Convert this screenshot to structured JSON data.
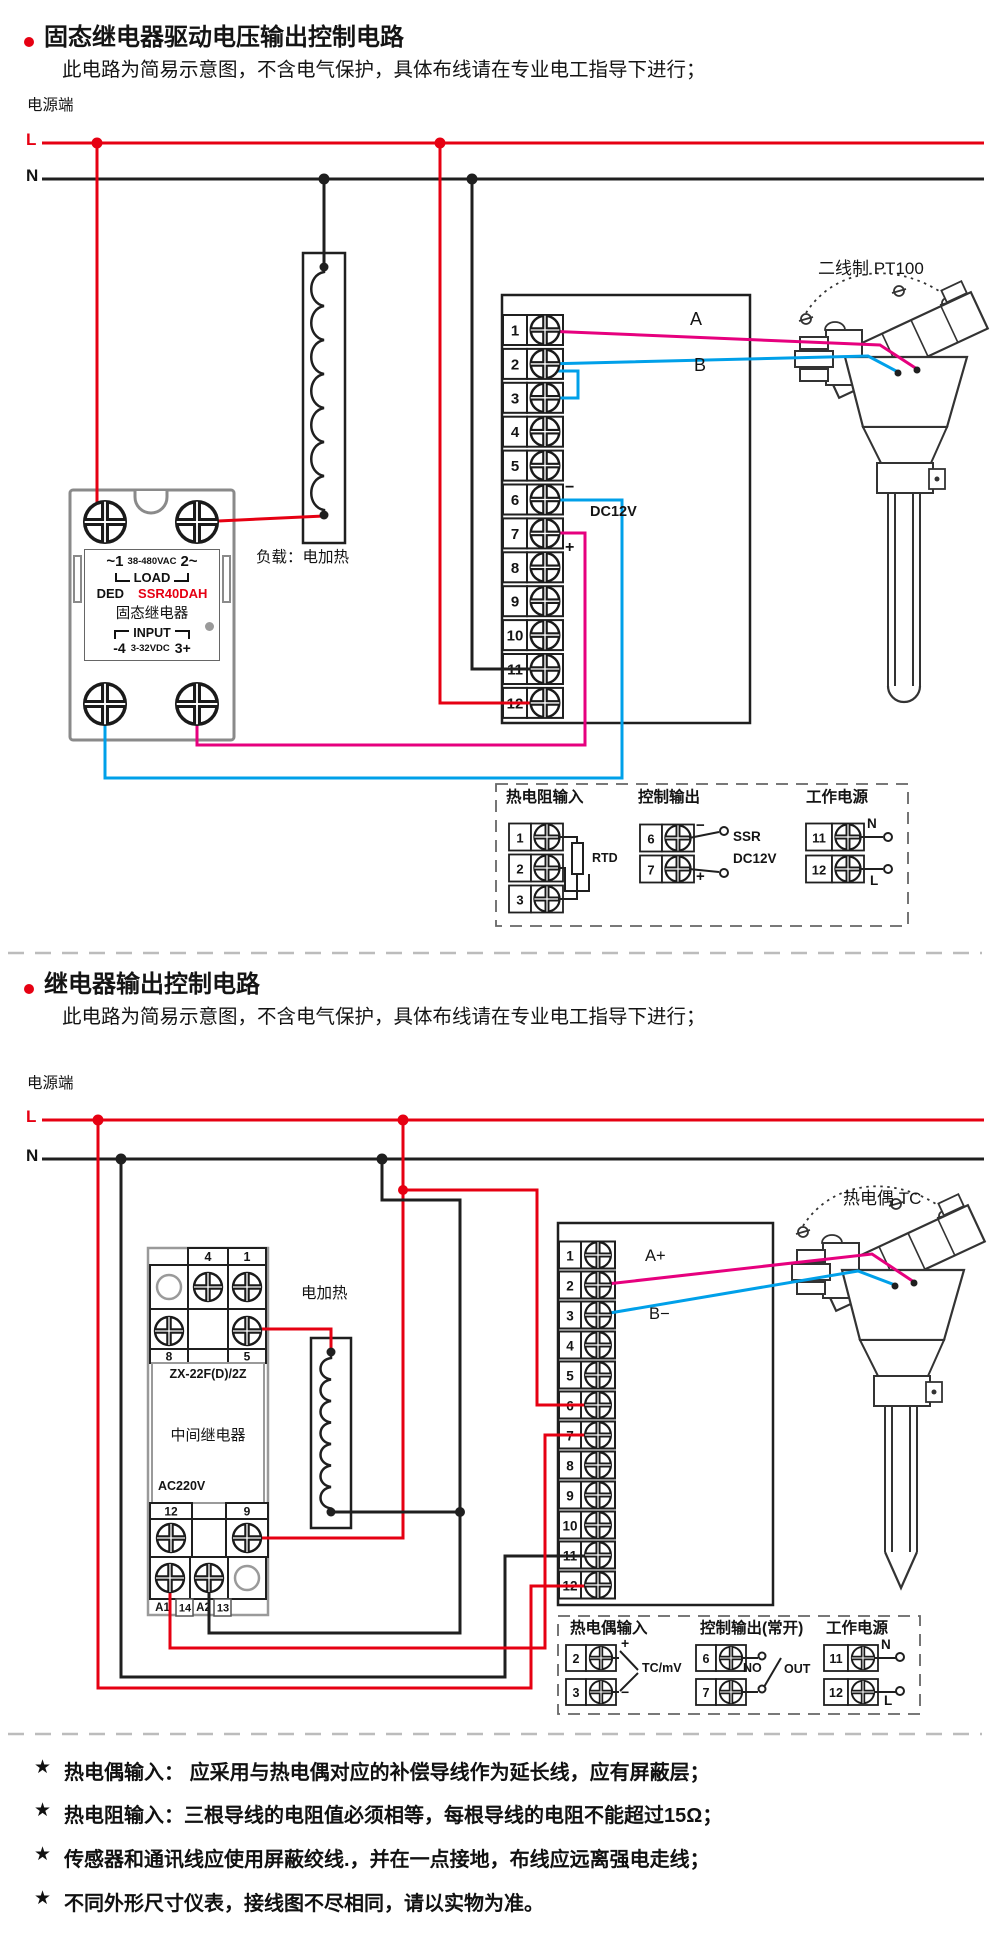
{
  "colors": {
    "red": "#e60012",
    "pink": "#e6007e",
    "blue": "#00a0e9",
    "black": "#1f1f1f",
    "gray": "#8a8a8a"
  },
  "s1": {
    "title": "固态继电器驱动电压输出控制电路",
    "subtitle": "此电路为简易示意图，不含电气保护，具体布线请在专业电工指导下进行；",
    "power": "电源端",
    "l": "L",
    "n": "N",
    "ssr": {
      "t1a": "~1",
      "t1b": "38-480VAC",
      "t1c": "2~",
      "load": "LOAD",
      "brand": "DED",
      "model": "SSR40DAH",
      "name": "固态继电器",
      "input": "INPUT",
      "t6a": "-4",
      "t6b": "3-32VDC",
      "t6c": "3+"
    },
    "load_label": "负载：电加热",
    "meter": {
      "terminals": [
        "1",
        "2",
        "3",
        "4",
        "5",
        "6",
        "7",
        "8",
        "9",
        "10",
        "11",
        "12"
      ],
      "a": "A",
      "b": "B",
      "minus": "−",
      "dc": "DC12V",
      "plus": "+"
    },
    "sensor": "二线制 PT100",
    "legend": {
      "g1": {
        "title": "热电阻输入",
        "terminals": [
          "1",
          "2",
          "3"
        ],
        "tag": "RTD"
      },
      "g2": {
        "title": "控制输出",
        "terminals": [
          "6",
          "7"
        ],
        "minus": "−",
        "plus": "+",
        "l1": "SSR",
        "l2": "DC12V"
      },
      "g3": {
        "title": "工作电源",
        "terminals": [
          "11",
          "12"
        ],
        "n": "N",
        "l": "L"
      }
    }
  },
  "s2": {
    "title": "继电器输出控制电路",
    "subtitle": "此电路为简易示意图，不含电气保护，具体布线请在专业电工指导下进行；",
    "power": "电源端",
    "l": "L",
    "n": "N",
    "relay": {
      "labels": {
        "t4": "4",
        "t1": "1",
        "t8": "8",
        "t5": "5",
        "t12": "12",
        "t9": "9",
        "a1": "A1",
        "t14": "14",
        "a2": "A2",
        "t13": "13"
      },
      "model": "ZX-22F(D)/2Z",
      "name": "中间继电器",
      "volt": "AC220V"
    },
    "heater": "电加热",
    "meter": {
      "terminals": [
        "1",
        "2",
        "3",
        "4",
        "5",
        "6",
        "7",
        "8",
        "9",
        "10",
        "11",
        "12"
      ],
      "a": "A+",
      "b": "B−"
    },
    "sensor": "热电偶 TC",
    "legend": {
      "g1": {
        "title": "热电偶输入",
        "terminals": [
          "2",
          "3"
        ],
        "plus": "+",
        "minus": "−",
        "tag": "TC/mV"
      },
      "g2": {
        "title": "控制输出(常开)",
        "terminals": [
          "6",
          "7"
        ],
        "no": "NO",
        "out": "OUT"
      },
      "g3": {
        "title": "工作电源",
        "terminals": [
          "11",
          "12"
        ],
        "n": "N",
        "l": "L"
      }
    }
  },
  "notes": [
    {
      "star": "★",
      "text": "热电偶输入： 应采用与热电偶对应的补偿导线作为延长线，应有屏蔽层；"
    },
    {
      "star": "★",
      "text": "热电阻输入：三根导线的电阻值必须相等，每根导线的电阻不能超过15Ω；"
    },
    {
      "star": "★",
      "text": "传感器和通讯线应使用屏蔽绞线.，并在一点接地，布线应远离强电走线；"
    },
    {
      "star": "★",
      "text": "不同外形尺寸仪表，接线图不尽相同，请以实物为准。"
    }
  ]
}
